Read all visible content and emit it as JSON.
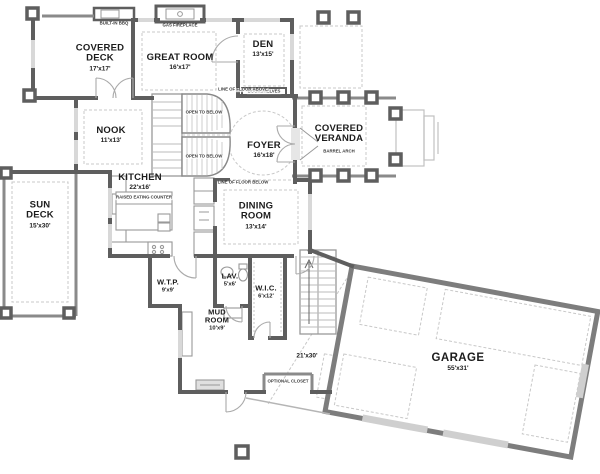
{
  "plan": {
    "type": "floor-plan",
    "colors": {
      "wall": "#5e5e5e",
      "medium_wall": "#8a8a8a",
      "light_line": "#c0c0c0",
      "window": "#d8d8d8",
      "text": "#1c1c1c",
      "background": "#ffffff"
    },
    "rooms": [
      {
        "name": "COVERED DECK",
        "dims": "17'x17'"
      },
      {
        "name": "GREAT ROOM",
        "dims": "16'x17'"
      },
      {
        "name": "DEN",
        "dims": "13'x15'"
      },
      {
        "name": "NOOK",
        "dims": "11'x13'"
      },
      {
        "name": "FOYER",
        "dims": "16'x18'"
      },
      {
        "name": "COVERED VERANDA",
        "dims": ""
      },
      {
        "name": "SUN DECK",
        "dims": "15'x30'"
      },
      {
        "name": "KITCHEN",
        "dims": "22'x16'"
      },
      {
        "name": "DINING ROOM",
        "dims": "13'x14'"
      },
      {
        "name": "W.T.P.",
        "dims": "9'x9'"
      },
      {
        "name": "LAV.",
        "dims": "5'x6'"
      },
      {
        "name": "W.I.C.",
        "dims": "6'x12'"
      },
      {
        "name": "MUD ROOM",
        "dims": "10'x9'"
      },
      {
        "name": "GARAGE",
        "dims": "55'x31'"
      }
    ],
    "annotations": [
      {
        "text": "GAS FIREPLACE"
      },
      {
        "text": "BUILT-IN BBQ"
      },
      {
        "text": "BOOKSHELVES"
      },
      {
        "text": "OPEN TO BELOW"
      },
      {
        "text": "OPEN TO BELOW"
      },
      {
        "text": "LINE OF FLOOR ABOVE"
      },
      {
        "text": "LINE OF FLOOR BELOW"
      },
      {
        "text": "BARREL ARCH"
      },
      {
        "text": "RAISED EATING COUNTER"
      },
      {
        "text": "OPTIONAL CLOSET"
      },
      {
        "text": "21'x30'"
      }
    ]
  }
}
